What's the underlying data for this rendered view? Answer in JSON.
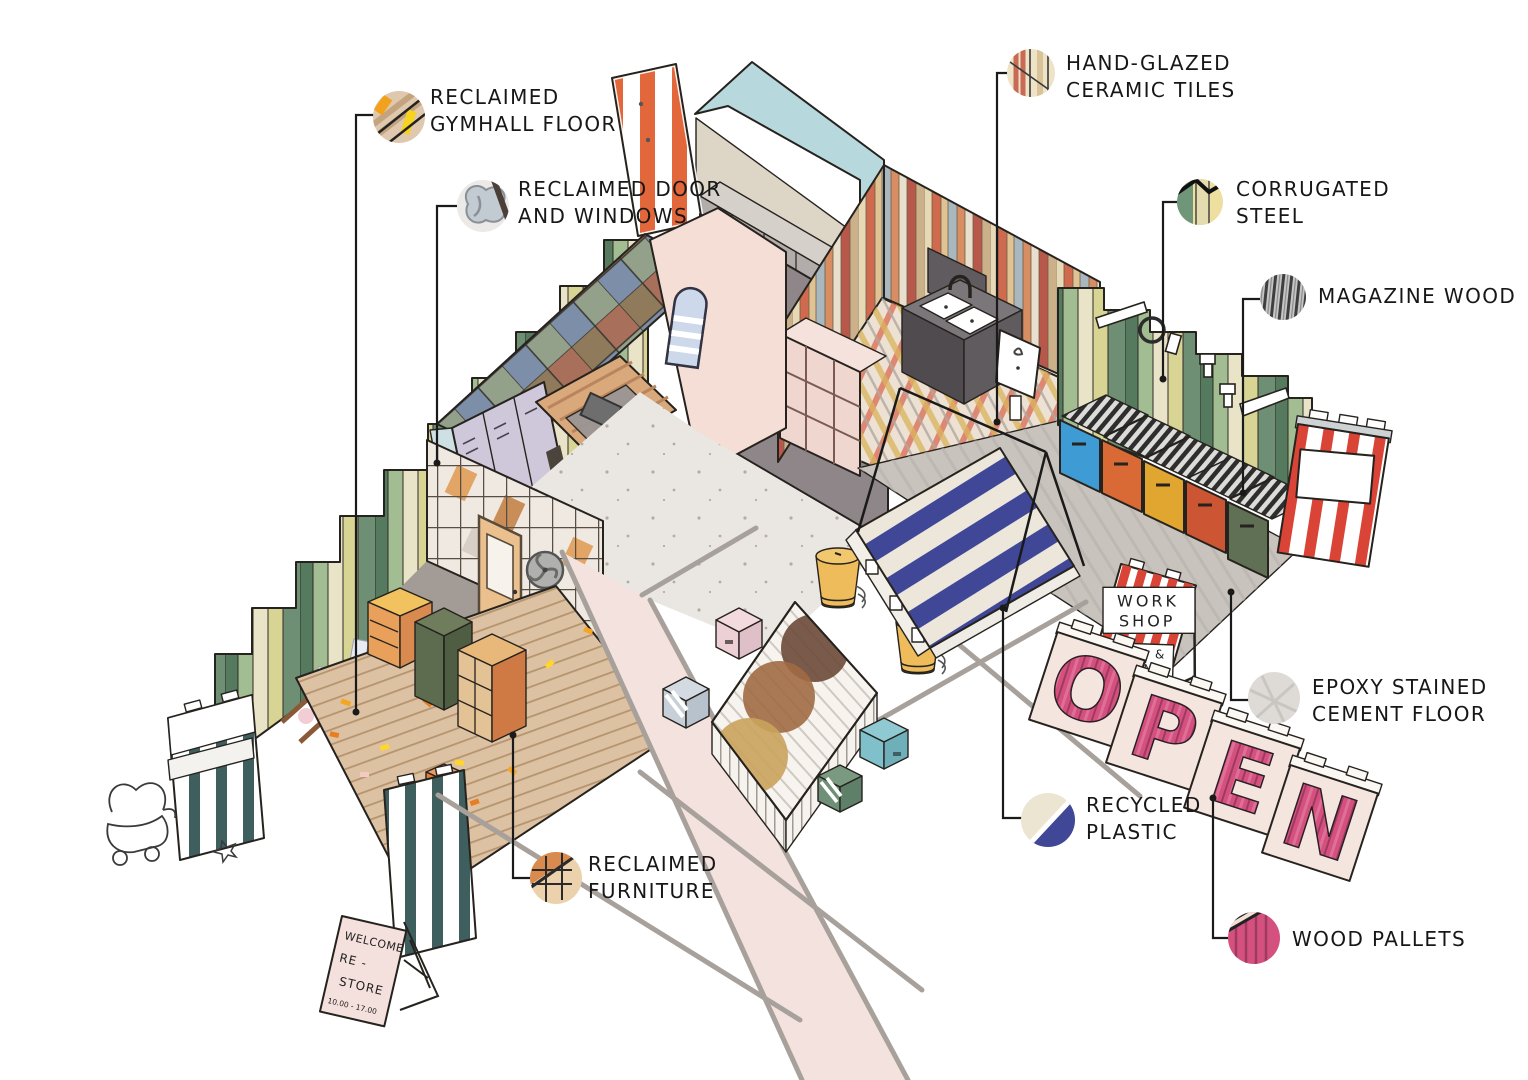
{
  "materials": [
    {
      "id": "reclaimed-gymhall-floor",
      "line1": "RECLAIMED",
      "line2": "GYMHALL FLOOR"
    },
    {
      "id": "reclaimed-door-windows",
      "line1": "RECLAIMED DOOR",
      "line2": "AND WINDOWS"
    },
    {
      "id": "hand-glazed-ceramic-tiles",
      "line1": "HAND-GLAZED",
      "line2": "CERAMIC TILES"
    },
    {
      "id": "corrugated-steel",
      "line1": "CORRUGATED",
      "line2": "STEEL"
    },
    {
      "id": "magazine-wood",
      "line1": "MAGAZINE WOOD",
      "line2": ""
    },
    {
      "id": "epoxy-stained-cement-floor",
      "line1": "EPOXY STAINED",
      "line2": "CEMENT FLOOR"
    },
    {
      "id": "recycled-plastic",
      "line1": "RECYCLED",
      "line2": "PLASTIC"
    },
    {
      "id": "wood-pallets",
      "line1": "WOOD PALLETS",
      "line2": ""
    },
    {
      "id": "reclaimed-furniture",
      "line1": "RECLAIMED",
      "line2": "FURNITURE"
    }
  ],
  "signs": {
    "workshop": {
      "line1": "WORK",
      "line2": "SHOP",
      "line3": "COME &",
      "line4": "JOIN"
    },
    "open": {
      "letters": [
        "O",
        "P",
        "E",
        "N"
      ]
    },
    "welcome": {
      "line1": "WELCOME",
      "line2": "RE -",
      "line3": "STORE",
      "line4": "10.00 - 17.00"
    }
  },
  "palette": {
    "corrugated_green": "#567a5e",
    "corrugated_sage": "#a2bd91",
    "corrugated_cream": "#e9e3c7",
    "pallet_pink": "#d4517f",
    "plastic_navy": "#3f4796",
    "plastic_cream": "#ece7da",
    "stripe_red": "#d94436",
    "stripe_orange": "#e2673a",
    "gate_teal": "#3f5f5e",
    "gym_floor_tan": "#dcc1a2",
    "cement_gray": "#c9c3bd",
    "concrete_light": "#eae6e1",
    "teal_wall": "#b7d8dc",
    "tile_rust": "#cf6a4f",
    "tile_cream": "#e8d9b5",
    "magazine_gray": "#3f3f3f",
    "epoxy_gray": "#dedbd7",
    "pink_walkway": "#f3e2de"
  }
}
